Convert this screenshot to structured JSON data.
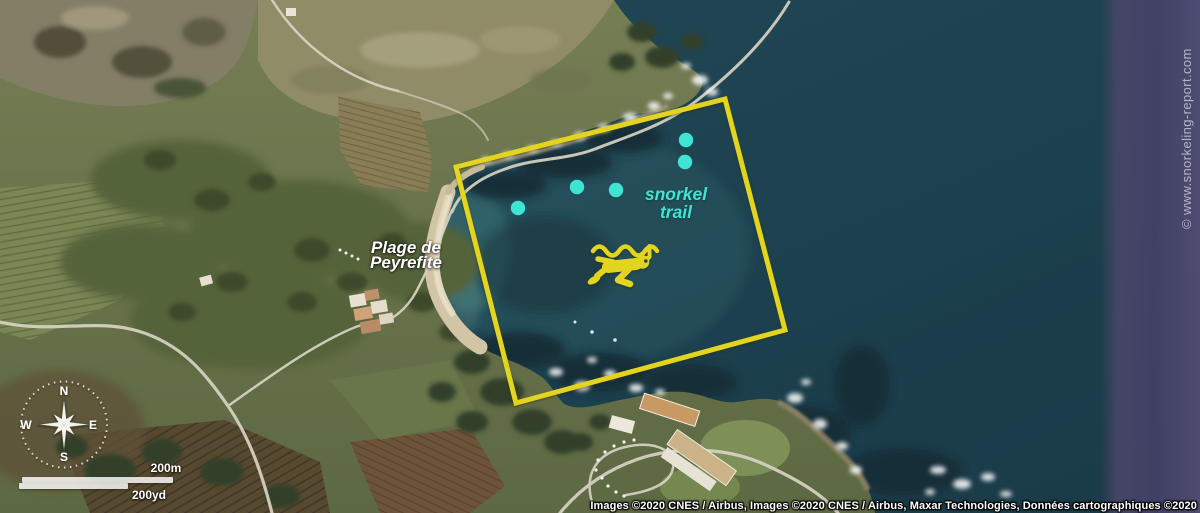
{
  "map": {
    "beach_label": {
      "line1": "Plage de",
      "line2": "Peyrefite"
    },
    "trail_label": {
      "line1": "snorkel",
      "line2": "trail"
    },
    "trail_marker_count": 5,
    "colors": {
      "zone_outline": "#e2d41f",
      "trail_accent": "#e2d41f",
      "trail_markers": "#3fe4d3",
      "trail_text": "#3fe4d3",
      "sea": "#1d3f4d",
      "label_text": "#ffffff"
    }
  },
  "compass": {
    "north": "N",
    "east": "E",
    "south": "S",
    "west": "W"
  },
  "scale_bar": {
    "metric": "200m",
    "imperial": "200yd"
  },
  "watermark": "© www.snorkeling-report.com",
  "attribution": "Images ©2020 CNES / Airbus, Images ©2020 CNES / Airbus, Maxar Technologies, Données cartographiques ©2020"
}
